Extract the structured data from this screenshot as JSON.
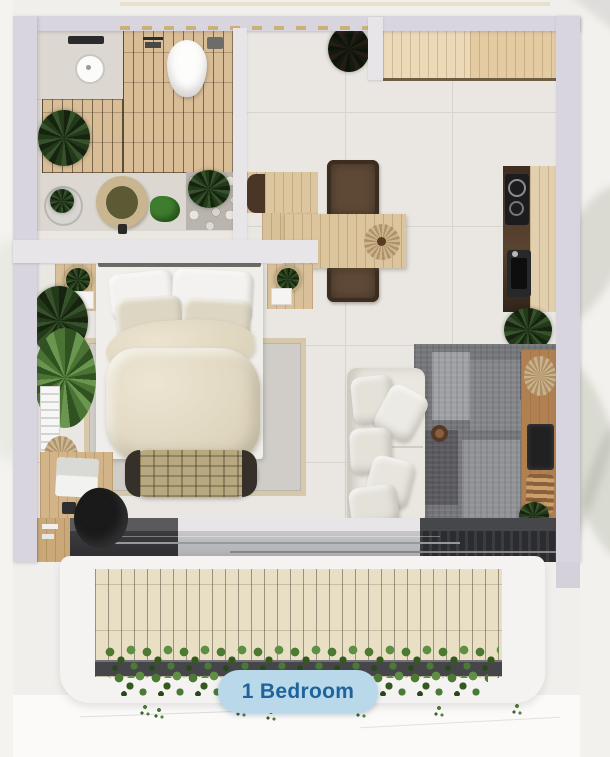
{
  "scene": {
    "type": "apartment-floor-plan-top-view",
    "rooms": [
      "bathroom",
      "kitchen",
      "dining-area",
      "bedroom",
      "living-room",
      "balcony"
    ]
  },
  "button": {
    "label": "1 Bedroom",
    "background": "#b9d8ea",
    "text_color": "#1f639b"
  },
  "colors": {
    "outer_wall": "#d9d5de",
    "inner_wall": "#e8e5e9",
    "floor_tile": "#eae7e3",
    "bathroom_wood": "#d8bd96",
    "kitchen_cabinet": "#e6cfa9",
    "counter_dark": "#3b2a20",
    "living_rug": "#75767a",
    "bedroom_rug": "#d0cdc8",
    "sofa": "#eae7e0",
    "balcony_deck": "#e9dfc5",
    "hedge_green": "#4d7a33"
  }
}
